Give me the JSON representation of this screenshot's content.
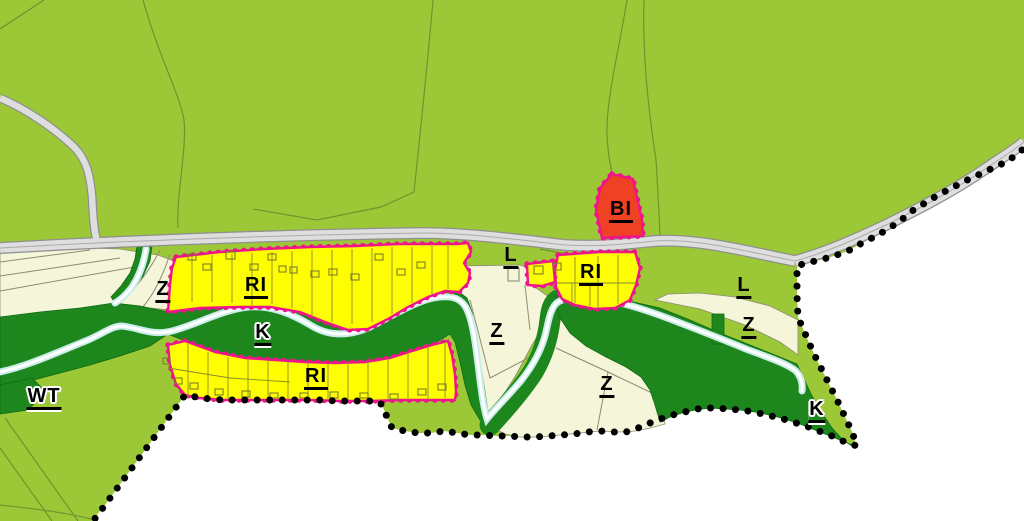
{
  "labels": [
    {
      "region": "west-gardens",
      "text": "Z"
    },
    {
      "region": "upper-recreation-strip",
      "text": "RI"
    },
    {
      "region": "stream-corridor",
      "text": "K"
    },
    {
      "region": "lower-recreation-strip",
      "text": "RI"
    },
    {
      "region": "center-near-road",
      "text": "L"
    },
    {
      "region": "center-recreation-parcel",
      "text": "RI"
    },
    {
      "region": "north-housing-parcel",
      "text": "BI"
    },
    {
      "region": "center-gardens",
      "text": "Z"
    },
    {
      "region": "center-south-gardens",
      "text": "Z"
    },
    {
      "region": "east-meadow",
      "text": "L"
    },
    {
      "region": "east-gardens",
      "text": "Z"
    },
    {
      "region": "southeast-corridor",
      "text": "K"
    },
    {
      "region": "southwest-water",
      "text": "WT"
    }
  ],
  "colors": {
    "outside_white": "#ffffff",
    "field_green": "#9cc837",
    "forest_dark_green": "#1d861d",
    "garden_cream": "#f5f5da",
    "recreation_yellow": "#fefe00",
    "zone_border_magenta": "#f0148c",
    "housing_red": "#ef4123",
    "road_fill": "#dedede",
    "road_edge": "#8f8f8f",
    "stream_blue": "#c9edea",
    "stream_core": "#ffffff",
    "parcel_line_green": "#6f942d",
    "parcel_line_gray": "#8c8c74",
    "boundary_dot_black": "#000000",
    "label_text": "#000000"
  }
}
